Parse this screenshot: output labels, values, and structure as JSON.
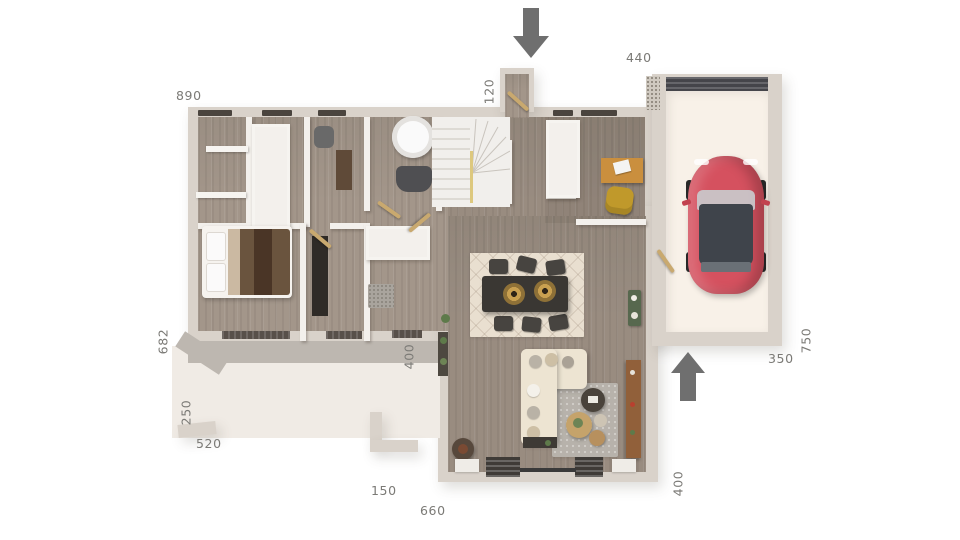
{
  "plan": {
    "title": "single-storey-house-floor-plan-3d",
    "dimensions": [
      {
        "id": "main-top-width",
        "value": "890"
      },
      {
        "id": "entry-porch-depth",
        "value": "120"
      },
      {
        "id": "garage-top-offset",
        "value": "440"
      },
      {
        "id": "main-left-height",
        "value": "682"
      },
      {
        "id": "terrace-left-height",
        "value": "250"
      },
      {
        "id": "terrace-bottom-width",
        "value": "520"
      },
      {
        "id": "patio-gap-width",
        "value": "150"
      },
      {
        "id": "living-bottom-width",
        "value": "660"
      },
      {
        "id": "living-right-height",
        "value": "400"
      },
      {
        "id": "garage-bottom-width",
        "value": "350"
      },
      {
        "id": "garage-right-height",
        "value": "750"
      },
      {
        "id": "terrace-wall-height",
        "value": "400"
      }
    ],
    "icons": [
      {
        "name": "front-entrance-arrow-down"
      },
      {
        "name": "garage-entrance-arrow-up"
      }
    ],
    "colors": {
      "background": "#ffffff",
      "exterior_wall": "#d9d2ca",
      "interior_wall": "#f3f0ec",
      "wood_floor": "#a3968a",
      "terrace": "#f0ebe5",
      "cast_shadow": "#bdb7b0",
      "garage_floor": "#f8f1e8",
      "garage_door": "#45454a",
      "car_body": "#d5515f",
      "car_glass": "#3f444b",
      "arrow": "#6f6f6f",
      "label_text": "#7b7a76",
      "door_leaf": "#c9a96f",
      "dining_table": "#3a3733",
      "pendant_gold": "#c9a050",
      "sofa_cream": "#ede4d2",
      "rug_cream": "#e9dfd0",
      "rug_gray": "#b7b2ab",
      "sideboard_wood": "#91603a",
      "desk_wood": "#ca8f3e",
      "office_chair_yellow": "#c0992b",
      "bed_blanket": "#6a543e",
      "console_green": "#57684e"
    },
    "furnishings": [
      "red-car",
      "staircase",
      "bathtub",
      "toilet",
      "double-bed",
      "wardrobe-closets",
      "dining-table-six-chairs",
      "pendant-lamps",
      "sectional-sofa",
      "coffee-tables",
      "sideboard",
      "desk-with-laptop",
      "office-chair",
      "green-console",
      "rugs",
      "plants"
    ]
  }
}
